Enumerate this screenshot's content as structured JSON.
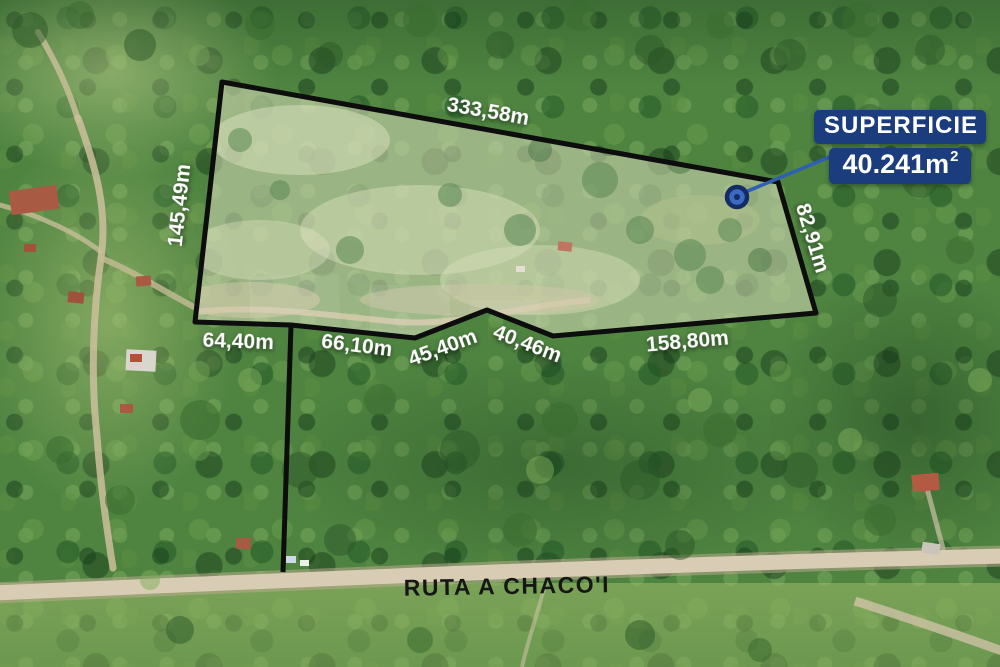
{
  "scene": {
    "type": "aerial-drone-photo-of-land-parcel"
  },
  "badge": {
    "title": "SUPERFICIE",
    "area_value": "40.241m",
    "area_superscript": "2"
  },
  "measurements": {
    "top": "333,58m",
    "left": "145,49m",
    "right": "82,91m",
    "bottom": [
      "64,40m",
      "66,10m",
      "45,40m",
      "40,46m",
      "158,80m"
    ]
  },
  "road": {
    "name": "RUTA A CHACO'I"
  },
  "colors": {
    "badge_background": "#1c3d7d",
    "badge_text": "#ffffff",
    "boundary_line": "#0d0d0d",
    "measurement_text": "#ffffff",
    "road_label_text": "#161616",
    "leader_line": "#2d5fb3",
    "marker_ring": "#142c63",
    "dirt_road": "#d8ccb4"
  }
}
